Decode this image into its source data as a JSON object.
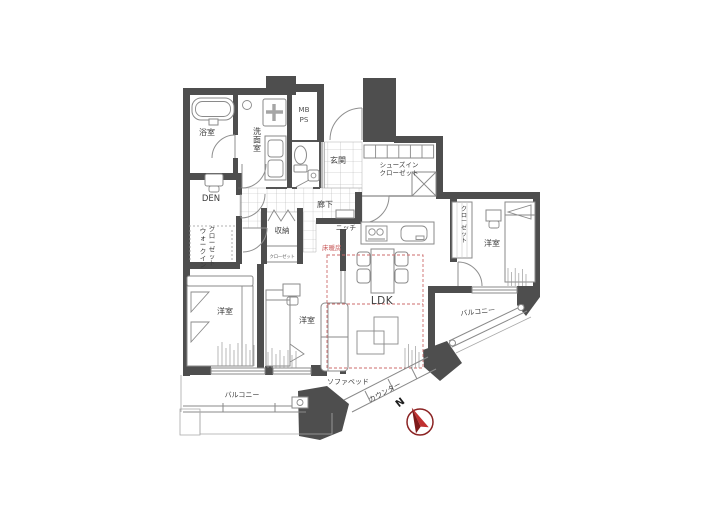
{
  "plan": {
    "rooms": {
      "bath": "浴室",
      "washroom": "洗面室",
      "mb": "MB",
      "ps": "PS",
      "entrance": "玄関",
      "shoes_closet_line1": "シューズイン",
      "shoes_closet_line2": "クローゼット",
      "den": "DEN",
      "wic_line1": "ウォークイン",
      "wic_line2": "クローゼット",
      "hallway": "廊下",
      "niche": "ニッチ",
      "storage": "収納",
      "small_closet": "クローゼット",
      "floor_heating": "床暖房",
      "ldk": "LDK",
      "bedroom_left": "洋室",
      "bedroom_middle": "洋室",
      "bedroom_right": "洋室",
      "closet_right": "クローゼット",
      "balcony_right": "バルコニー",
      "balcony_bottom": "バルコニー",
      "sofa_bed": "ソファベッド",
      "counter": "カウンター",
      "north": "N"
    },
    "colors": {
      "wall": "#4e4e4e",
      "floor_heating_red": "#c85a5a",
      "compass_red": "#c03030",
      "compass_dark_red": "#7e1a1a"
    }
  }
}
